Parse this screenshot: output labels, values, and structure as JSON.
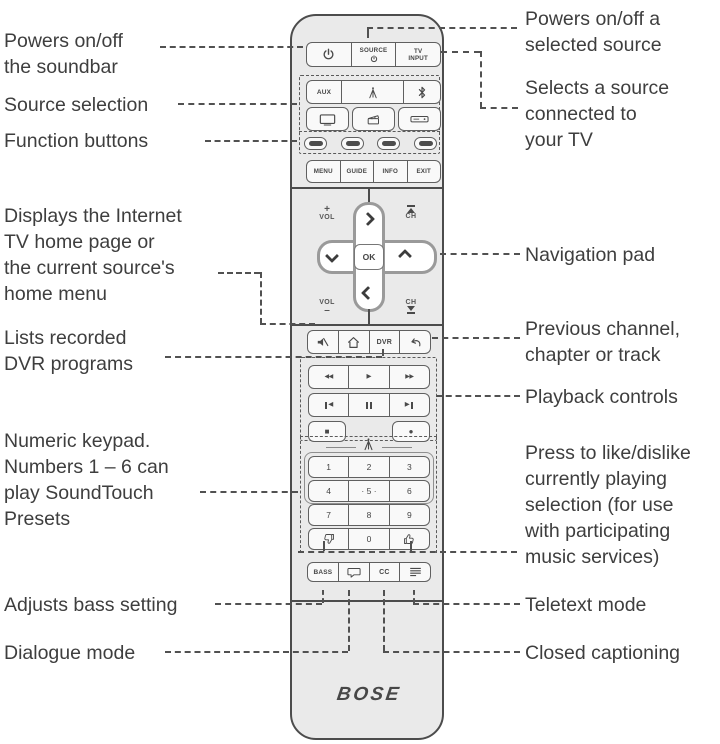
{
  "annotations": {
    "left": [
      {
        "id": "power-soundbar",
        "text": "Powers on/off\nthe soundbar"
      },
      {
        "id": "source-selection",
        "text": "Source selection"
      },
      {
        "id": "function-buttons",
        "text": "Function buttons"
      },
      {
        "id": "home-menu",
        "text": "Displays the Internet\nTV home page or\nthe current source's\nhome menu"
      },
      {
        "id": "dvr-programs",
        "text": "Lists recorded\nDVR programs"
      },
      {
        "id": "numeric-keypad",
        "text": "Numeric keypad.\nNumbers 1 – 6 can\nplay SoundTouch\nPresets"
      },
      {
        "id": "bass",
        "text": "Adjusts bass setting"
      },
      {
        "id": "dialogue",
        "text": "Dialogue mode"
      }
    ],
    "right": [
      {
        "id": "power-source",
        "text": "Powers on/off a\nselected source"
      },
      {
        "id": "tv-input",
        "text": "Selects a source\nconnected to\nyour TV"
      },
      {
        "id": "nav-pad",
        "text": "Navigation pad"
      },
      {
        "id": "previous",
        "text": "Previous channel,\nchapter or track"
      },
      {
        "id": "playback",
        "text": "Playback controls"
      },
      {
        "id": "like-dislike",
        "text": "Press to like/dislike\ncurrently playing\nselection (for use\nwith participating\nmusic services)"
      },
      {
        "id": "teletext",
        "text": "Teletext mode"
      },
      {
        "id": "closed-captioning",
        "text": "Closed captioning"
      }
    ]
  },
  "remote": {
    "brand": "BOSE",
    "power_row": {
      "source": "SOURCE",
      "tv_input": "TV\nINPUT"
    },
    "source_pad": {
      "aux": "AUX"
    },
    "menu_row": [
      "MENU",
      "GUIDE",
      "INFO",
      "EXIT"
    ],
    "nav": {
      "vol_plus": "+",
      "vol": "VOL",
      "vol_minus": "–",
      "ch": "CH",
      "ok": "OK"
    },
    "shortcut_row": {
      "dvr": "DVR"
    },
    "playback": {
      "rewind": "◀◀",
      "play": "▶",
      "fast_forward": "▶▶",
      "skip_back": "◀",
      "skip_forward": "▶",
      "stop": "■",
      "record": "●"
    },
    "keypad": {
      "digits": [
        "1",
        "2",
        "3",
        "4",
        "· 5 ·",
        "6",
        "7",
        "8",
        "9",
        "0"
      ]
    },
    "audio_row": {
      "bass": "BASS",
      "cc": "CC"
    }
  },
  "icons": {
    "power-icon": "circle with vertical line (power symbol)",
    "soundtouch-antenna-icon": "broadcast antenna",
    "bluetooth-icon": "bluetooth mark",
    "tv-icon": "television screen",
    "media-player-icon": "clapperboard",
    "cable-box-icon": "set-top box",
    "function-button": "blank oval pill",
    "mute-icon": "speaker with slash",
    "home-icon": "house outline",
    "return-icon": "curved back arrow",
    "channel-up-icon": "triangle up with bar",
    "channel-down-icon": "triangle down with bar",
    "pause-icon": "two vertical bars",
    "thumbs-down-icon": "thumb down outline",
    "thumbs-up-icon": "thumb up outline",
    "dialogue-icon": "speech bubble",
    "teletext-icon": "stacked text lines"
  },
  "colors": {
    "remote_body": "#eaeaea",
    "button_fill": "#f9f9f9",
    "outline": "#4c4c4c",
    "label_text": "#3e3e3e",
    "leader": "#515151",
    "dark_pill": "#4d4d4d"
  }
}
